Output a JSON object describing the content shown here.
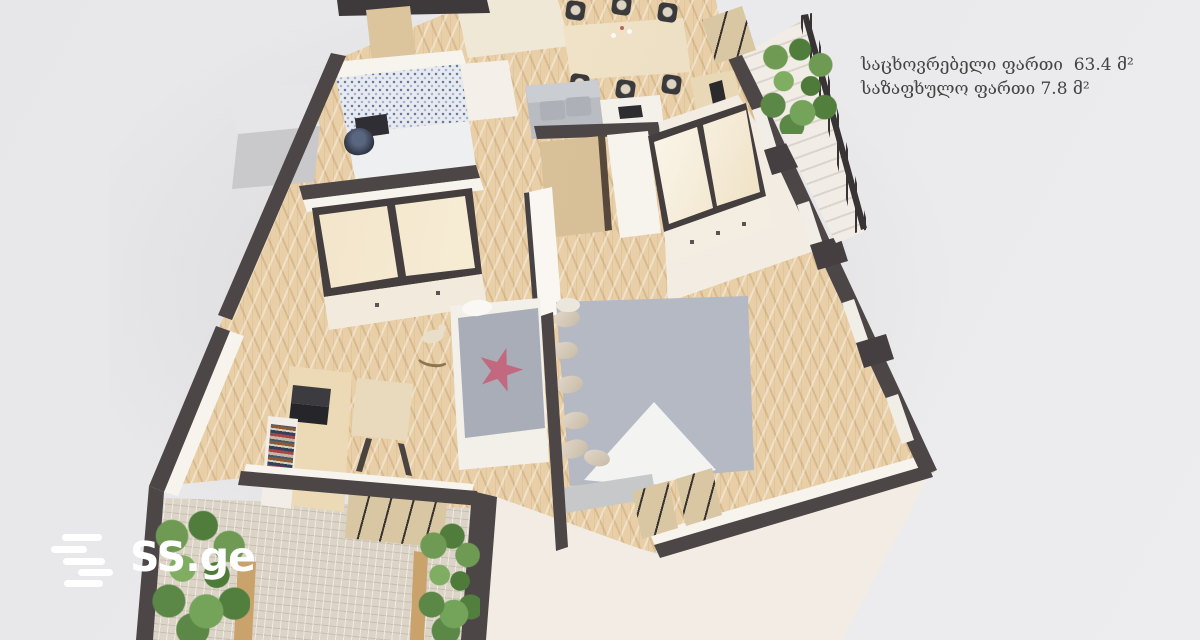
{
  "scene": {
    "description": "3D isometric render of an apartment floor plan on light gray background",
    "background_color": "#e9e9eb",
    "colors": {
      "wall": "#4c4647",
      "wood_floor": "#e8cfa7",
      "balcony_tile": "#ddd4c8",
      "bathroom_mosaic": "#e7eaf0",
      "facade": "#f8f4ef",
      "mirror_wardrobe": "#eedcbd",
      "bed": "#b5b9c3",
      "sofa": "#b9bcc1",
      "plants": "#5b8747",
      "star_blanket": "#c3697f",
      "furniture_wood": "#ecd9b6",
      "concrete_slab": "#c9c9cc"
    },
    "rooms": [
      "living-dining",
      "kitchen",
      "bathroom",
      "hallway-wardrobe",
      "kids-room",
      "master-bedroom",
      "balcony-top-right",
      "balcony-bottom"
    ]
  },
  "overlay": {
    "line1": "საცხოვრებელი ფართი  63.4 მ²",
    "line2": "საზაფხულო ფართი 7.8 მ²",
    "text_color": "#454443"
  },
  "watermark": {
    "brand": "SS.ge",
    "color": "#ffffff",
    "icon": "speed-lines-icon"
  }
}
